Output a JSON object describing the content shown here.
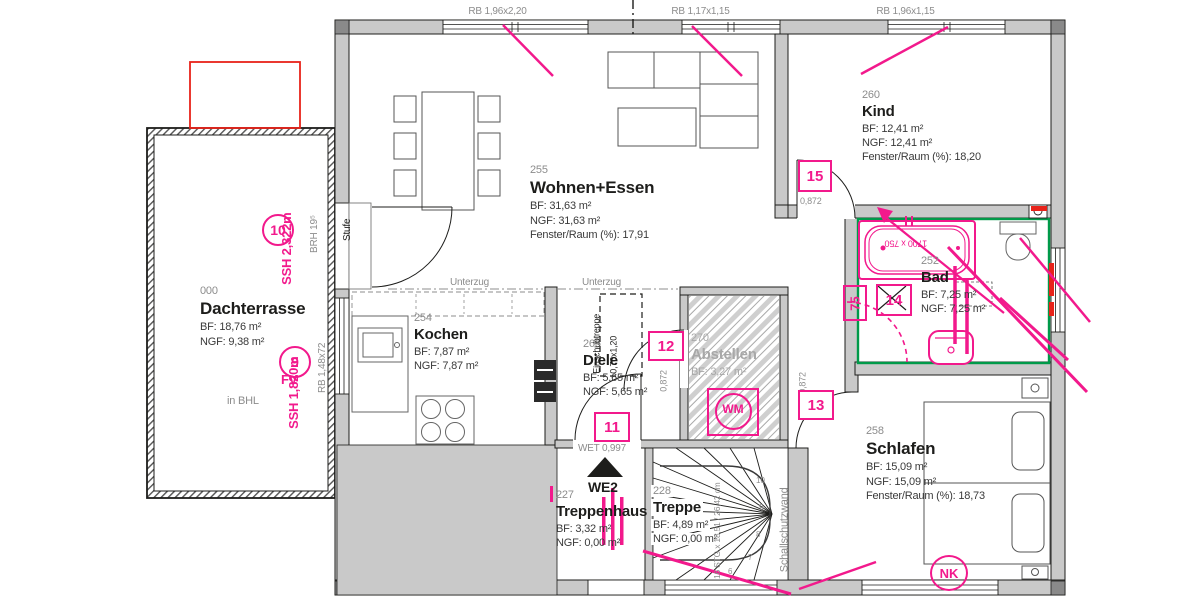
{
  "colors": {
    "pink": "#f2198c",
    "red": "#e8231a",
    "green": "#009a49",
    "wall_gray": "#c9c9c9",
    "text_gray": "#8c8c8c",
    "ink": "#1d1d1b"
  },
  "window_labels": {
    "w1": "RB 1,96x2,20",
    "w2": "RB 1,17x1,15",
    "w3": "RB 1,96x1,15",
    "left": "RB 1,48x72"
  },
  "rooms": {
    "dachterrasse": {
      "number": "000",
      "name": "Dachterrasse",
      "bf": "BF: 18,76 m²",
      "ngf": "NGF: 9,38 m²",
      "note": "in BHL"
    },
    "wohnen": {
      "number": "255",
      "name": "Wohnen+Essen",
      "bf": "BF: 31,63 m²",
      "ngf": "NGF: 31,63 m²",
      "fenster": "Fenster/Raum (%): 17,91"
    },
    "kind": {
      "number": "260",
      "name": "Kind",
      "bf": "BF: 12,41 m²",
      "ngf": "NGF: 12,41 m²",
      "fenster": "Fenster/Raum (%): 18,20"
    },
    "bad": {
      "number": "252",
      "name": "Bad",
      "bf": "BF: 7,25 m²",
      "ngf": "NGF: 7,25 m²"
    },
    "schlafen": {
      "number": "258",
      "name": "Schlafen",
      "bf": "BF: 15,09 m²",
      "ngf": "NGF: 15,09 m²",
      "fenster": "Fenster/Raum (%): 18,73"
    },
    "kochen": {
      "number": "254",
      "name": "Kochen",
      "bf": "BF: 7,87 m²",
      "ngf": "NGF: 7,87 m²"
    },
    "diele": {
      "number": "265",
      "name": "Diele",
      "bf": "BF: 5,65 m²",
      "ngf": "NGF: 5,65 m²"
    },
    "abstellen": {
      "number": "270",
      "name": "Abstellen",
      "bf": "BF: 3,27 m²"
    },
    "treppenhaus": {
      "number": "227",
      "name": "Treppenhaus",
      "bf": "BF: 3,32 m²",
      "ngf": "NGF: 0,00 m²"
    },
    "treppe": {
      "number": "228",
      "name": "Treppe",
      "bf": "BF: 4,89 m²",
      "ngf": "NGF: 0,00 m²"
    }
  },
  "markers": {
    "m9": "9",
    "m10": "10",
    "m11": "11",
    "m12": "12",
    "m13": "13",
    "m14": "14",
    "m15": "15",
    "m75": "75",
    "wm": "WM",
    "nk": "NK"
  },
  "pink_labels": {
    "ssh_top": "SSH 2,322m",
    "fv": "FV",
    "ssh_bottom": "SSH 1,820m",
    "bathtub": "1700 x 750"
  },
  "dims": {
    "door_top": "0,872",
    "door_mid": "0,872",
    "door_bottom": "0,872",
    "wet": "WET 0,997",
    "we2": "WE2",
    "brh": "BRH 19⁵",
    "stufe": "Stufe",
    "unterzug_1": "Unterzug",
    "unterzug_2": "Unterzug",
    "schallschutzwand": "Schallschutzwand",
    "attic_ladder": "Einschubtreppe",
    "attic_size": "0,70x1,20",
    "stairs": "16 STG x 18,51 / 26,42 cm"
  },
  "stair_numbers": {
    "n10": "10",
    "n9": "9",
    "n8": "8",
    "n7": "7",
    "n6": "6"
  }
}
